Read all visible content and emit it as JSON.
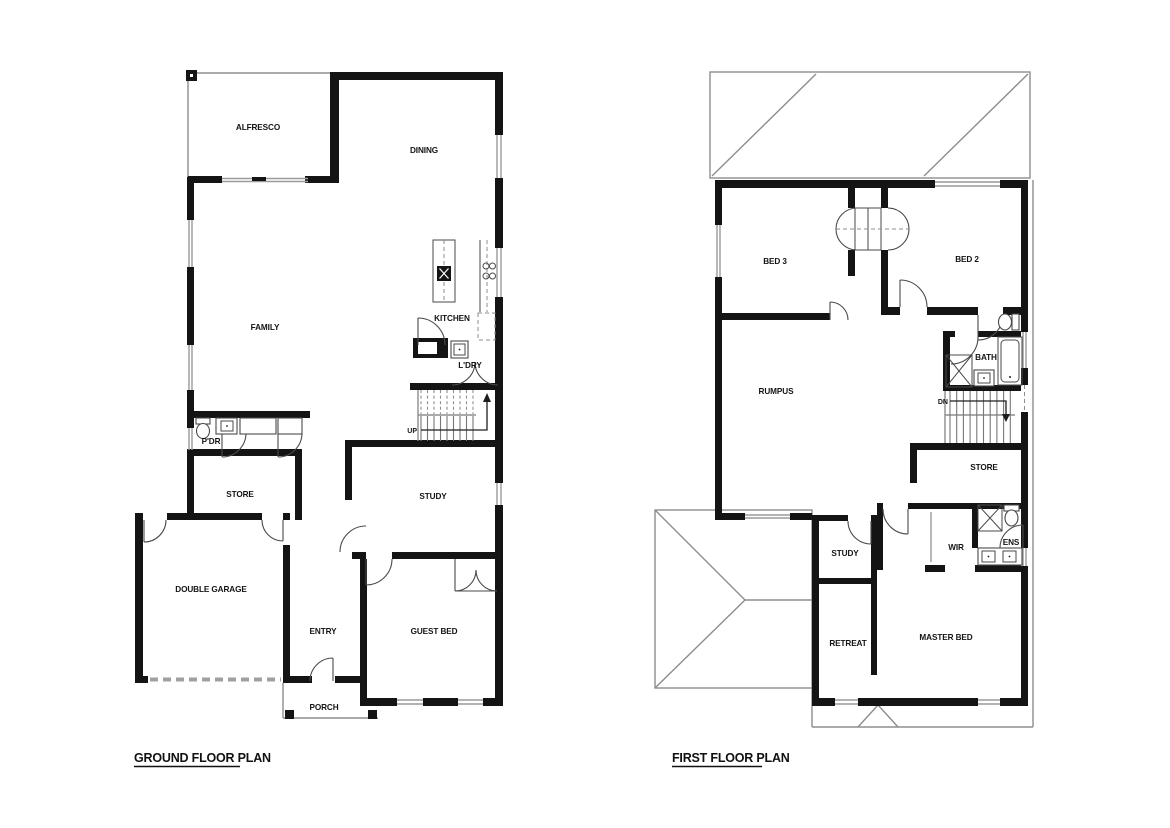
{
  "sheet": {
    "kind": "architectural floor plans"
  },
  "ground_floor": {
    "title": "GROUND FLOOR PLAN",
    "rooms": {
      "alfresco": "ALFRESCO",
      "dining": "DINING",
      "family": "FAMILY",
      "kitchen": "KITCHEN",
      "laundry": "L'DRY",
      "up": "UP",
      "powder": "P'DR",
      "store": "STORE",
      "study": "STUDY",
      "double_garage": "DOUBLE GARAGE",
      "entry": "ENTRY",
      "guest_bed": "GUEST BED",
      "porch": "PORCH"
    }
  },
  "first_floor": {
    "title": "FIRST FLOOR PLAN",
    "rooms": {
      "bed3": "BED 3",
      "bed2": "BED 2",
      "rumpus": "RUMPUS",
      "bath": "BATH",
      "dn": "DN",
      "store": "STORE",
      "study": "STUDY",
      "wir": "WIR",
      "ens": "ENS",
      "retreat": "RETREAT",
      "master_bed": "MASTER BED"
    }
  },
  "colors": {
    "wall": "#141414",
    "thin_line": "#8d8d8d",
    "background": "#ffffff",
    "text": "#141414"
  }
}
